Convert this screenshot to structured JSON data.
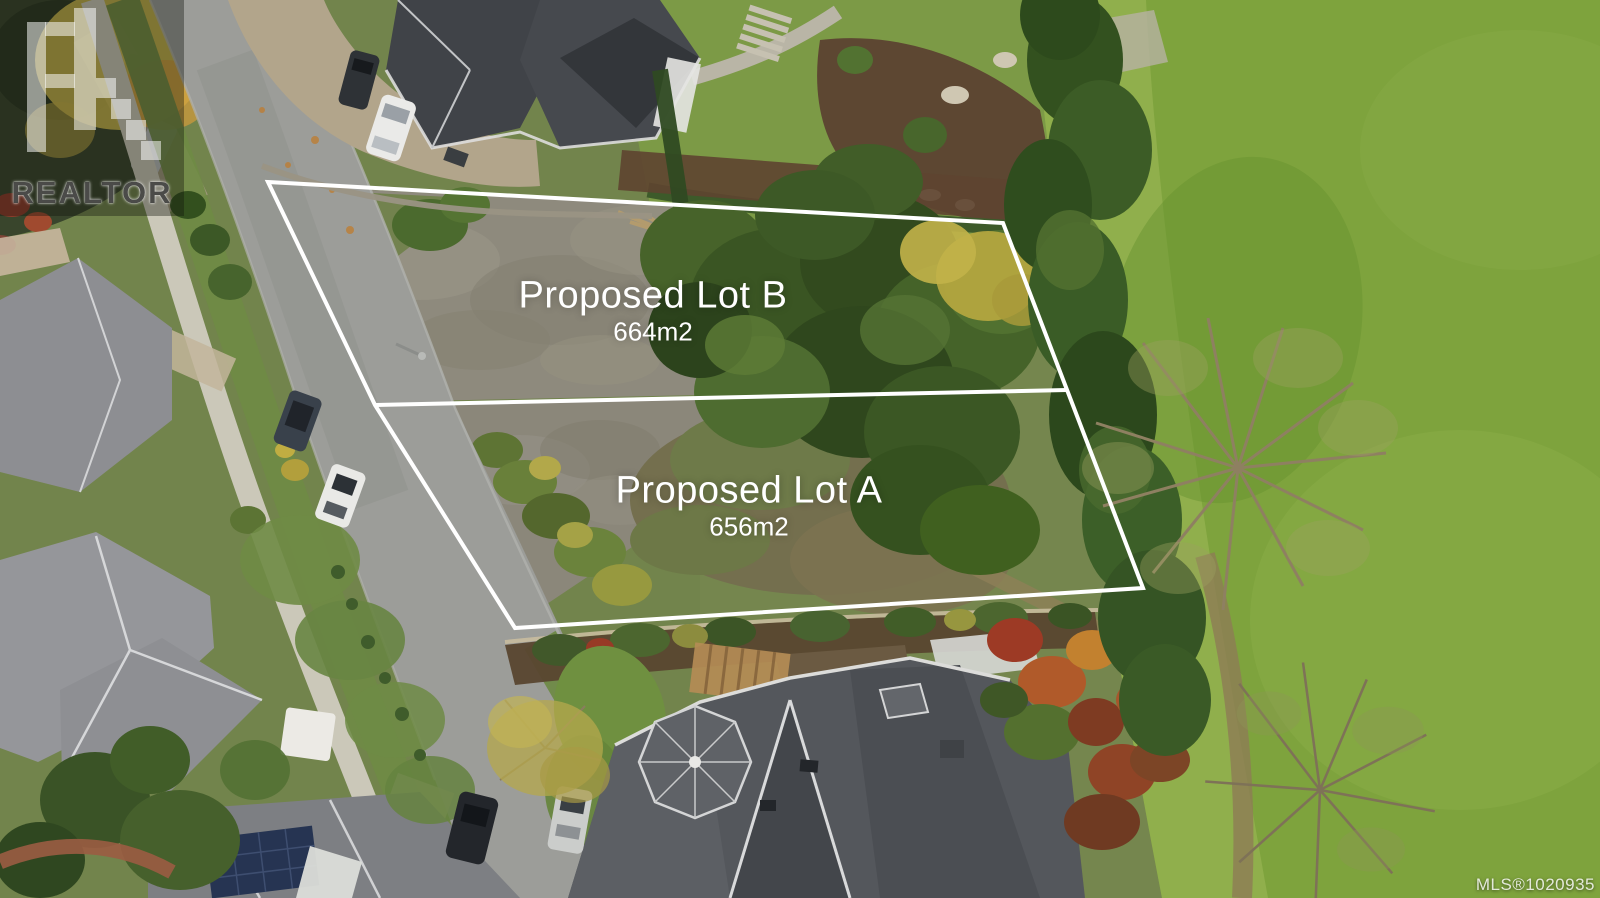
{
  "watermark": {
    "brand": "REALTOR"
  },
  "lots": {
    "lot_b": {
      "label": "Proposed Lot B",
      "area": "664m2"
    },
    "lot_a": {
      "label": "Proposed Lot A",
      "area": "656m2"
    }
  },
  "mls": {
    "label": "MLS®1020935"
  },
  "scene": {
    "type": "aerial-drone-photo",
    "features": [
      "residential street running diagonally on the left",
      "two proposed vacant lots outlined in white",
      "golf course fairway on the right",
      "houses with gray roofs around the lots",
      "parked cars on the street",
      "mature trees and gardens"
    ],
    "colors": {
      "boundary_line": "#ffffff",
      "label_text": "#ffffff",
      "road": "#9c9d99",
      "gravel_lot": "#8e8a7d",
      "fairway_green": "#7ea33d",
      "tree_green": "#3a5523",
      "roof_dark": "#54575c",
      "roof_light": "#95969a"
    }
  }
}
